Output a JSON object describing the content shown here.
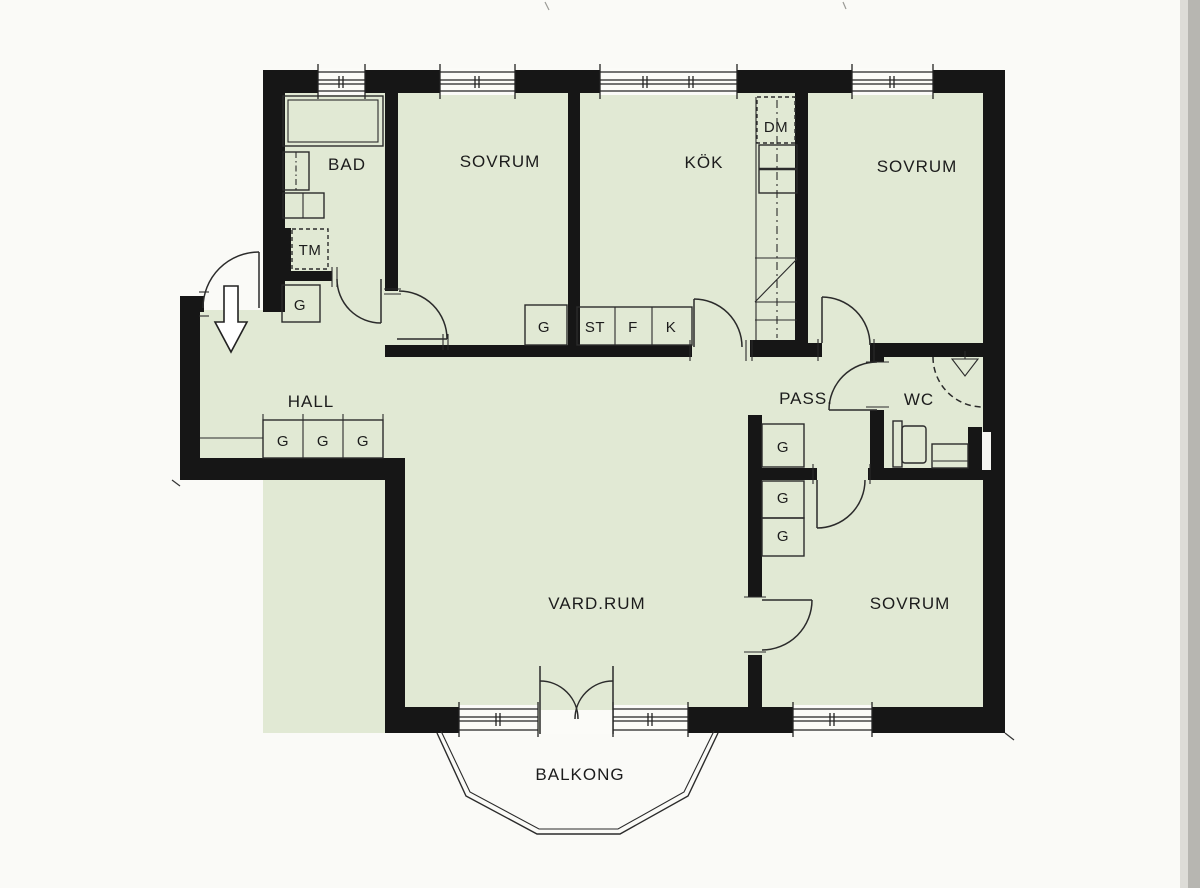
{
  "colors": {
    "floor": "#e1e9d4",
    "wall": "#161616",
    "line": "#2b2b2b",
    "paper": "#fafaf7"
  },
  "rooms": {
    "bad": "BAD",
    "sovrum_top_left": "SOVRUM",
    "kok": "KÖK",
    "sovrum_top_right": "SOVRUM",
    "hall": "HALL",
    "pass": "PASS.",
    "wc": "WC",
    "vardagsrum": "VARD.RUM",
    "sovrum_bottom": "SOVRUM",
    "balkong": "BALKONG"
  },
  "fixtures": {
    "dishwasher": "DM",
    "washing_machine": "TM",
    "st_cabinet": "ST",
    "fridge": "F",
    "k_cabinet": "K"
  },
  "closets": {
    "bad": "G",
    "sovrum_top_left": "G",
    "hall": [
      "G",
      "G",
      "G"
    ],
    "pass": [
      "G",
      "G",
      "G"
    ]
  }
}
